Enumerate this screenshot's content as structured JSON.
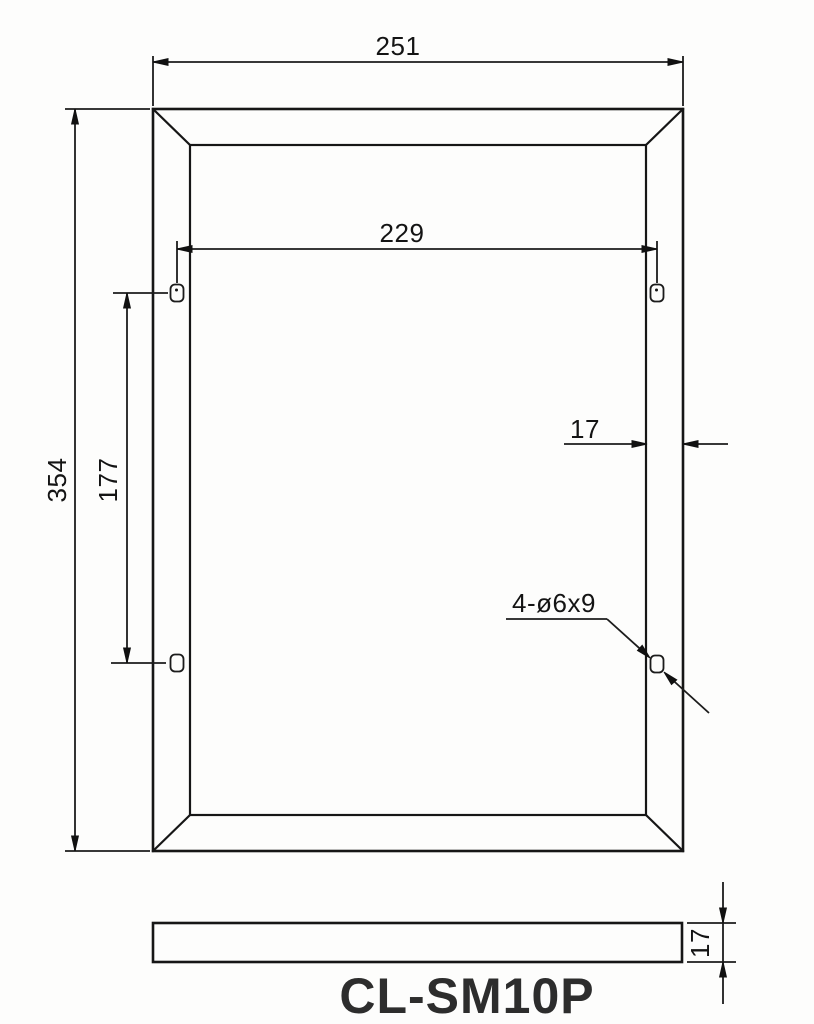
{
  "drawing": {
    "title": "CL-SM10P",
    "dims": {
      "overall_width": "251",
      "hole_span_width": "229",
      "overall_height": "354",
      "hole_span_height": "177",
      "frame_face_width": "17",
      "hole_callout": "4-ø6x9",
      "profile_thickness": "17"
    },
    "colors": {
      "line": "#161616",
      "background": "#fdfdfc",
      "title_text": "#2d2d2d"
    }
  }
}
